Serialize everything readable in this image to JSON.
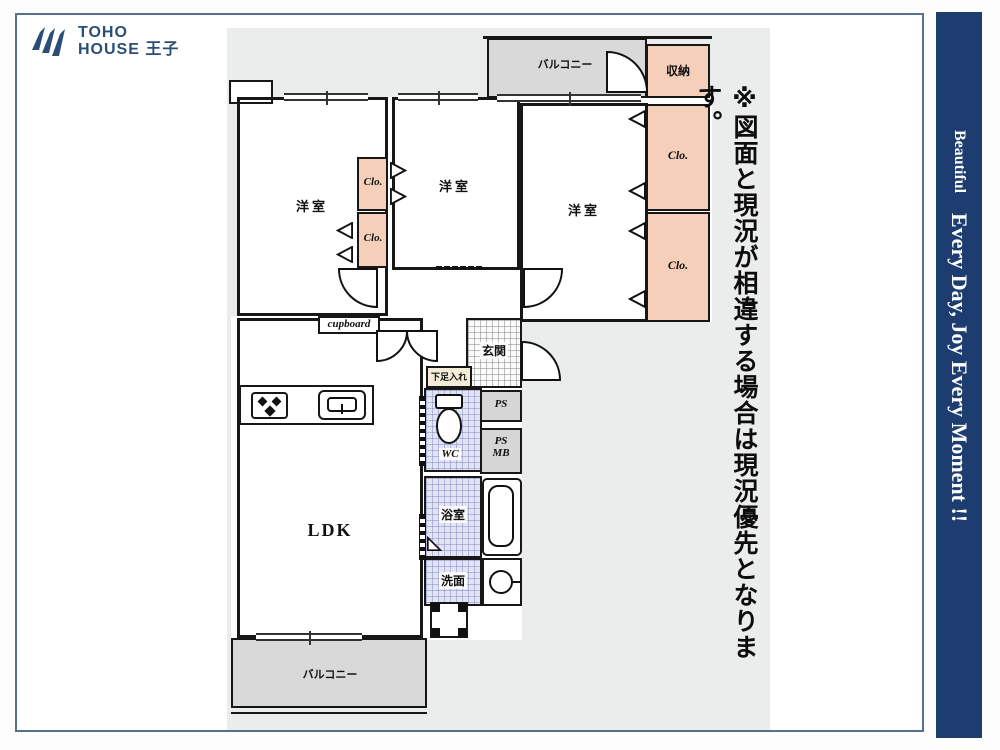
{
  "page": {
    "logo": {
      "line1": "TOHO",
      "line2": "HOUSE 王子"
    },
    "disclaimer": "※図面と現況が相違する場合は現況優先となります。",
    "banner": {
      "small": "Beautiful",
      "large": "Every Day, Joy Every Moment !!"
    }
  },
  "floorplan": {
    "balcony_top": "バルコニー",
    "balcony_bottom": "バルコニー",
    "storage": "収納",
    "closet": "Clo.",
    "bedroom": "洋室",
    "entrance": "玄関",
    "shoe_cabinet": "下足入れ",
    "cupboard": "cupboard",
    "ps": "PS",
    "mb": "MB",
    "wc": "WC",
    "bathroom": "浴室",
    "washroom": "洗面",
    "ldk": "LDK"
  },
  "colors": {
    "banner_navy": "#1d3c6f",
    "logo_navy": "#2b4d78",
    "closet_salmon": "#f6cfba",
    "balcony_gray": "#d9d9d9",
    "panel_gray": "#ebedec",
    "wet_area_lavender": "#e2e3f3",
    "shoe_cabinet_beige": "#f4ecd8",
    "wall_black": "#171717",
    "frame_border": "#57708c"
  }
}
